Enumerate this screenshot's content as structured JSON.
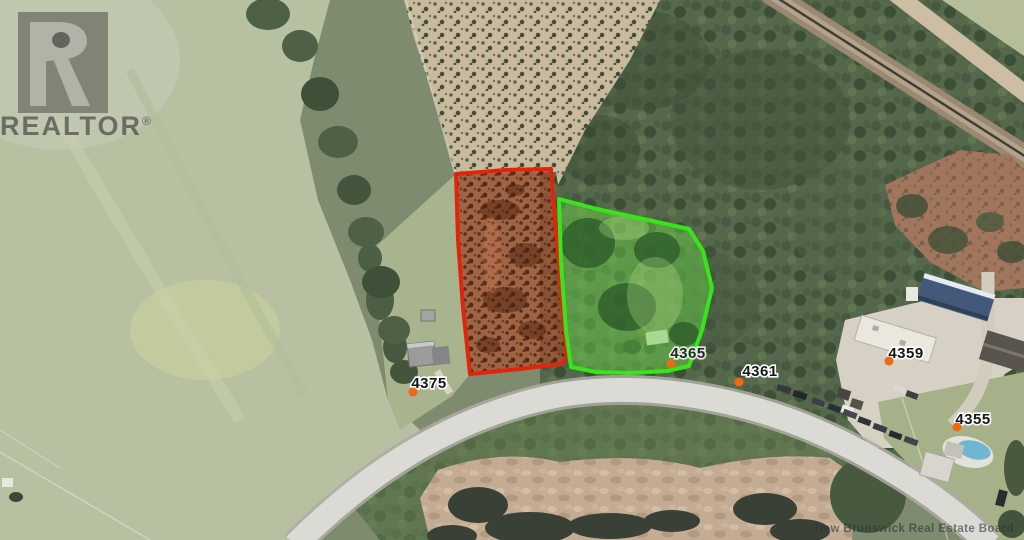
{
  "watermarks": {
    "realtor": {
      "text": "REALTOR",
      "registered": "®"
    },
    "board": "New Brunswick Real Estate Board"
  },
  "map": {
    "type": "aerial-photo-with-parcel-overlays",
    "markers": [
      {
        "label": "4375"
      },
      {
        "label": "4365"
      },
      {
        "label": "4361"
      },
      {
        "label": "4359"
      },
      {
        "label": "4355"
      }
    ],
    "marker_dot_color": "#ee6a12",
    "parcels": [
      {
        "name": "subject-lot-red",
        "outline_color": "#e1250c",
        "fill_color": "rgba(177,78,44,0.62)"
      },
      {
        "name": "adjacent-lot-green",
        "outline_color": "#38e41a",
        "fill_color": "rgba(108,219,72,0.44)"
      }
    ]
  }
}
